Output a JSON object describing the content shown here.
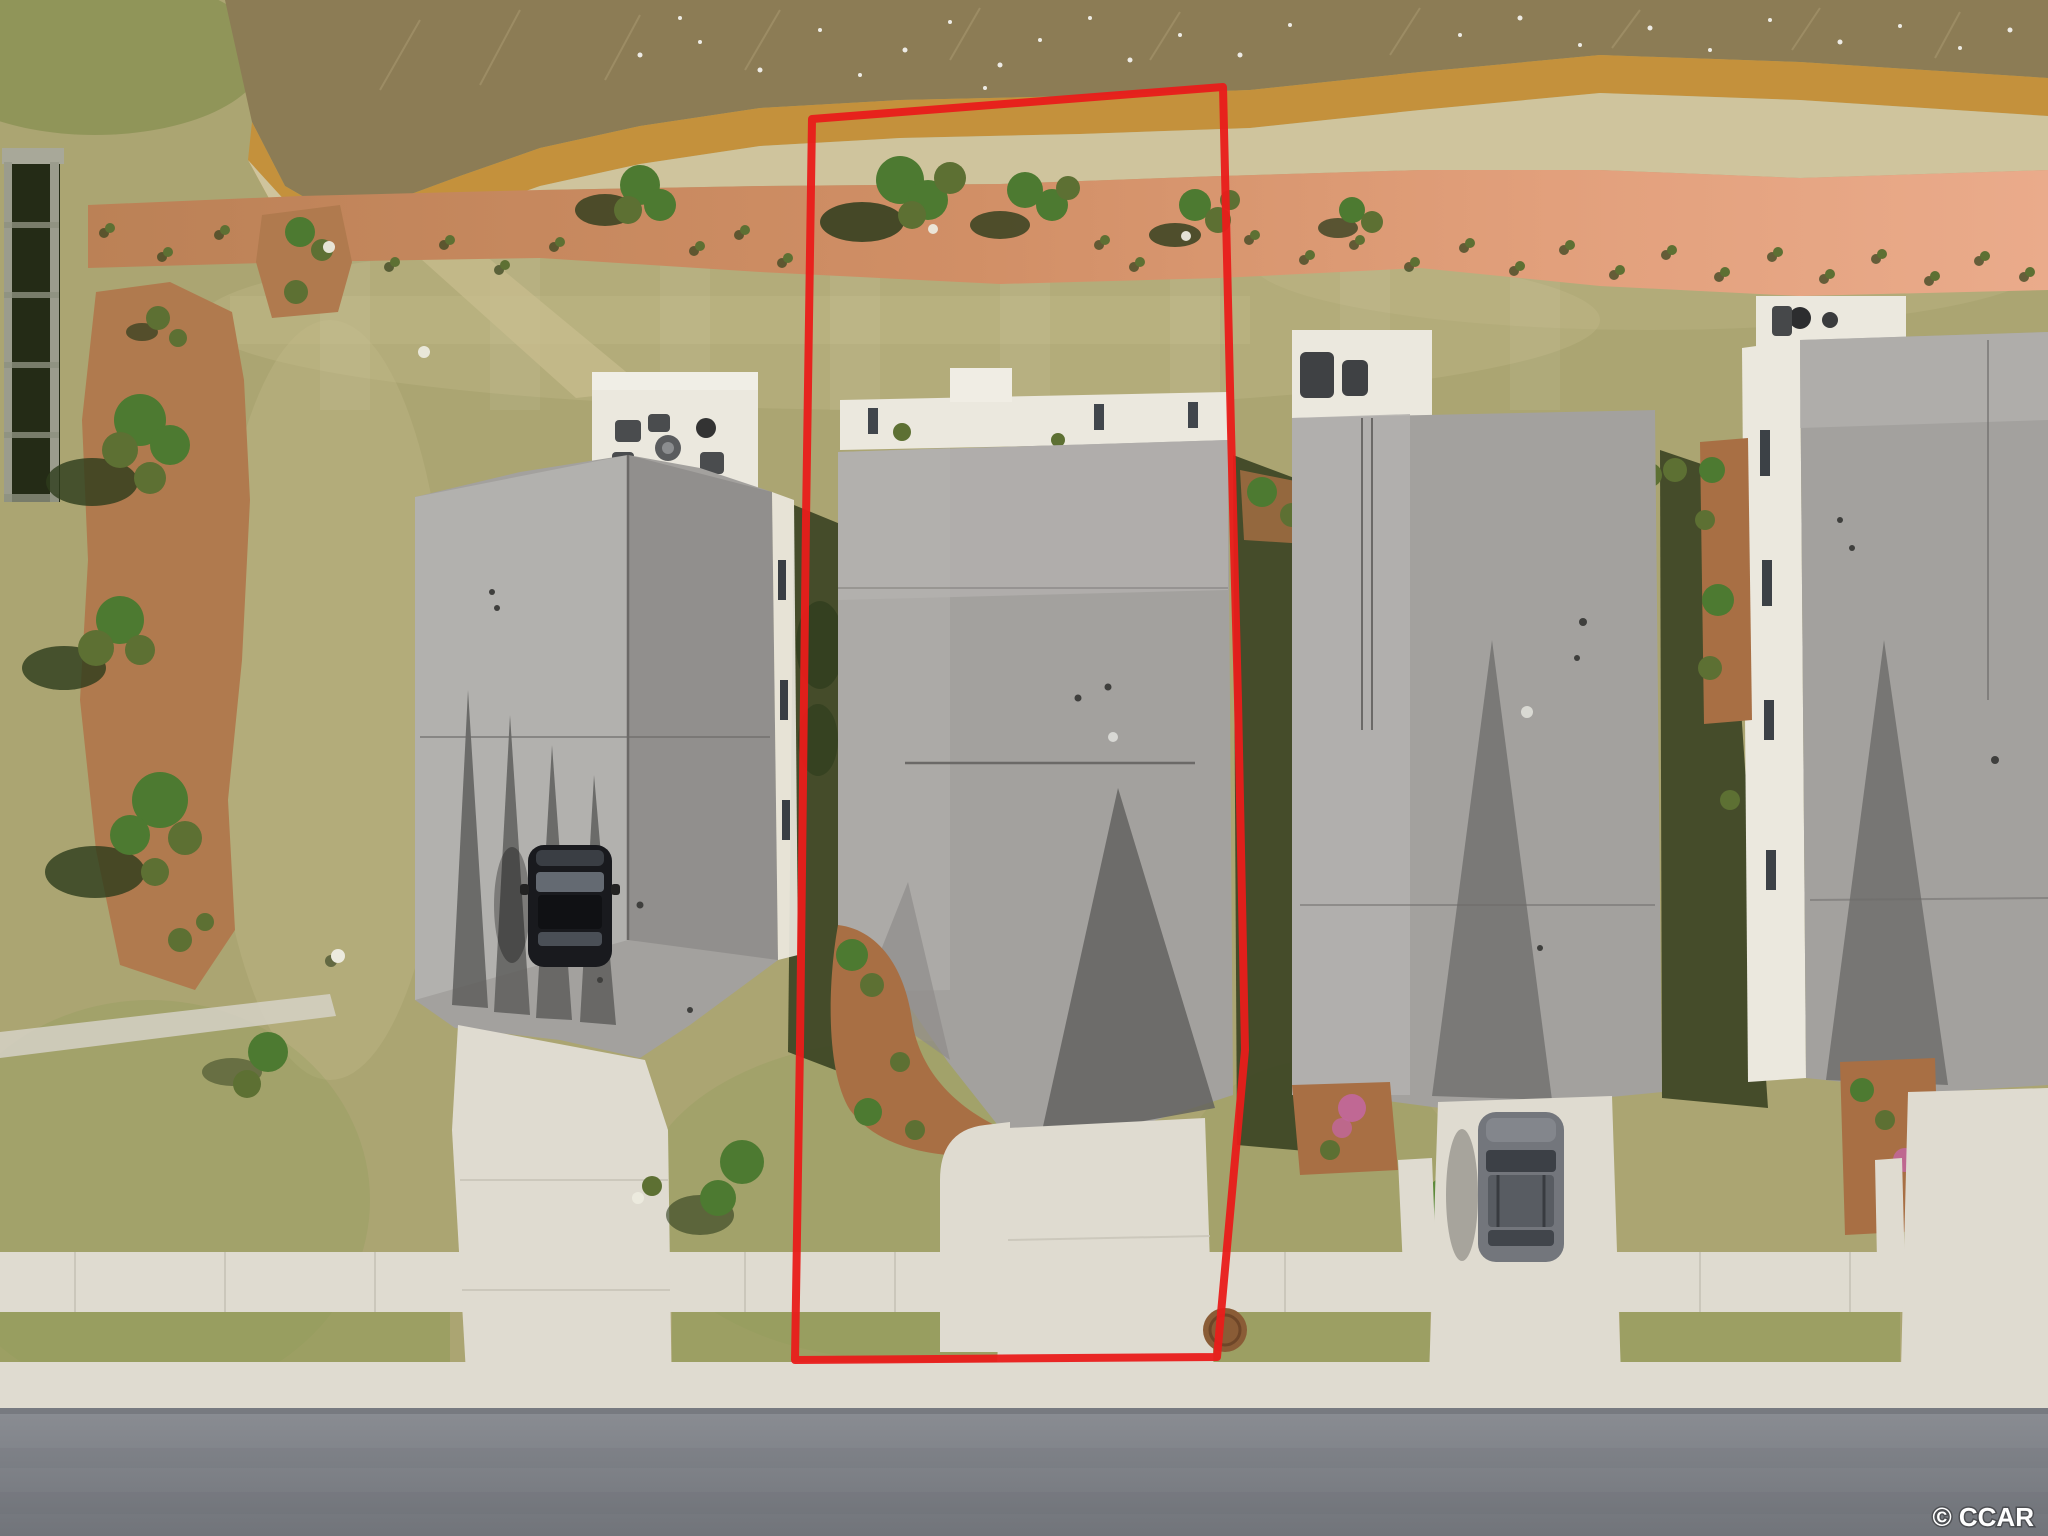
{
  "image": {
    "width": 2048,
    "height": 1536
  },
  "watermark": {
    "text": "© CCAR"
  },
  "boundary": {
    "color": "#e91c1a",
    "stroke_width": 8,
    "points": [
      [
        812,
        119
      ],
      [
        1223,
        87
      ],
      [
        1231,
        430
      ],
      [
        1238,
        700
      ],
      [
        1245,
        1050
      ],
      [
        1217,
        1357
      ],
      [
        795,
        1360
      ],
      [
        800,
        1045
      ],
      [
        806,
        520
      ]
    ]
  },
  "palette": {
    "water": "#8c7c55",
    "ripple": "#b6a57c",
    "bank": "#c4913c",
    "shore": "#cfc49d",
    "mulch-left": "#b07a4e",
    "mulch-mid": "#d18f66",
    "mulch-right": "#eaab8b",
    "grass": "#aba572",
    "grass-light": "#c4b98a",
    "grass-green": "#8f9b58",
    "grass-dark": "#7f8a4a",
    "roof": "#a3a19e",
    "roof-light": "#b4b2af",
    "roof-dark": "#8e8c8a",
    "roof-plane": "#5f5f5d",
    "ridge": "#6b6967",
    "concrete": "#dfdbd0",
    "wallwhite": "#ebe8de",
    "shadow": "#3a4222",
    "tree": "#4d7a31",
    "tree-dark": "#2d3c1c",
    "bush": "#5d7033",
    "mulchbed": "#a86f44",
    "street": "#83868c",
    "car-black": "#191a1e",
    "car-gray": "#73767c",
    "manhole": "#8a5c36",
    "pink-bloom": "#c2679d",
    "flower-yellow": "#d4b033",
    "watermark": "#ffffff"
  }
}
